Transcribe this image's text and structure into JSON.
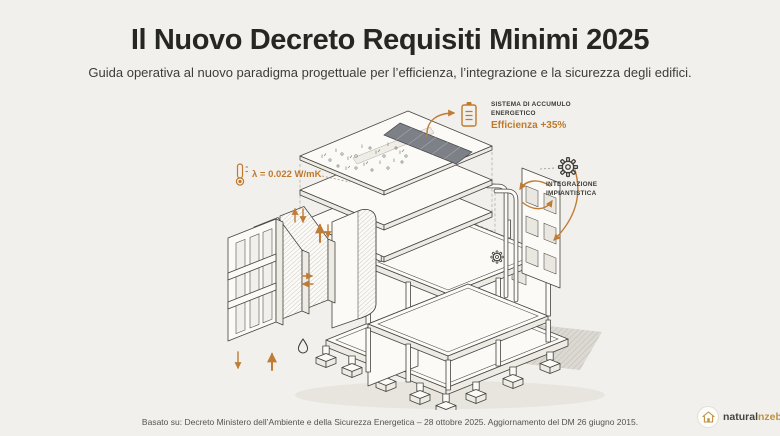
{
  "theme": {
    "background": "#f1f0ec",
    "accent_orange": "#bf7a2e",
    "ink": "#2b2a27",
    "muted_text": "#55544f"
  },
  "header": {
    "title": "Il Nuovo Decreto Requisiti Minimi 2025",
    "subtitle": "Guida operativa al nuovo paradigma progettuale per l’efficienza, l’integrazione e la sicurezza degli edifici."
  },
  "illustration": {
    "description": "Esploso assonometrico di un edificio: tetto fotovoltaico e tetto verde, solai, telaio strutturale, pannelli isolanti, impianti e fondazioni",
    "icons": [
      "battery-icon",
      "thermometer-icon",
      "gear-icon",
      "water-drop-icon"
    ]
  },
  "annotations": {
    "storage": {
      "label_line1": "SISTEMA DI ACCUMULO",
      "label_line2": "ENERGETICO",
      "value": "Efficienza +35%"
    },
    "insulation": {
      "value": "λ = 0.022 W/mK"
    },
    "systems": {
      "label_line1": "INTEGRAZIONE",
      "label_line2": "IMPIANTISTICA"
    }
  },
  "footer": {
    "text": "Basato su: Decreto Ministero dell’Ambiente e della Sicurezza Energetica – 28 ottobre 2025. Aggiornamento del DM 26 giugno 2015."
  },
  "brand": {
    "name_primary": "natural",
    "name_secondary": "nzeb.it"
  }
}
